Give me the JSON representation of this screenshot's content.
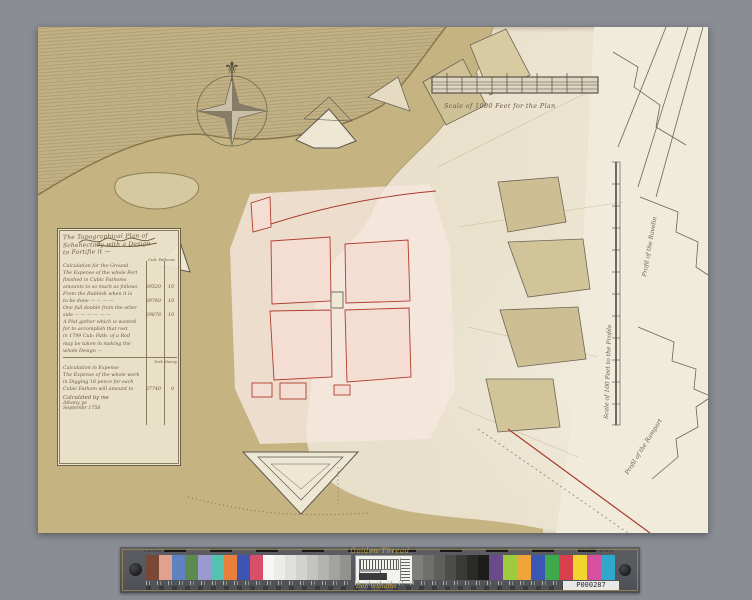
{
  "page": {
    "background": "#8a8e94"
  },
  "map": {
    "paper": "#e9e1cc",
    "ink": "#55504a",
    "river_tan": "#c5b482",
    "land_tan": "#c2b184",
    "town_pink": "#f4ded4",
    "accent_red": "#a93a2c",
    "cartouche": {
      "title_lines": [
        "The Topographical Plan of",
        "Schenectady with a Design",
        "to Fortifie it —"
      ],
      "col_header": "Cub: Fathoms",
      "rows": [
        {
          "t": "Calculation for the Ground",
          "v": "",
          "s": ""
        },
        {
          "t": "The Expense of the whole Fort",
          "v": "",
          "s": ""
        },
        {
          "t": "finished in Cubic Fathoms",
          "v": "",
          "s": ""
        },
        {
          "t": "amounts to so much as follows",
          "v": "69520",
          "s": "10"
        },
        {
          "t": "From the Rubbish when it is",
          "v": "",
          "s": ""
        },
        {
          "t": "to be done — — — —",
          "v": "39760",
          "s": "10"
        },
        {
          "t": "One full double from the other",
          "v": "",
          "s": ""
        },
        {
          "t": "side — — — — — —",
          "v": "29876",
          "s": "10"
        },
        {
          "t": "A Plat gather which is wanted",
          "v": "",
          "s": ""
        },
        {
          "t": "for to accomplish that rest",
          "v": "",
          "s": ""
        },
        {
          "t": "in 1799 Cub: Fath: of a Rod",
          "v": "",
          "s": ""
        },
        {
          "t": "may be taken in making the",
          "v": "",
          "s": ""
        },
        {
          "t": "whole Design —",
          "v": "",
          "s": ""
        }
      ],
      "col_header2": "York Money",
      "rows2": [
        {
          "t": "Calculation in Expense",
          "v": "",
          "s": ""
        },
        {
          "t": "The Expense of the whole work",
          "v": "",
          "s": ""
        },
        {
          "t": "in Digging 16 pence for each",
          "v": "",
          "s": ""
        },
        {
          "t": "Cubic Fathom will amount to",
          "v": "37740",
          "s": "0"
        }
      ],
      "closing": "Calculated by me",
      "place": "Albany ye",
      "date": "Septembr 1756"
    },
    "scale_bar_caption": "Scale of 1000 Feet for the Plan",
    "profile_scale_caption": "Scale of 100 Feet to the Profils",
    "label_profile_upper": "Profil of the Ravelin",
    "label_profile_lower": "Profil of the Rampart"
  },
  "calibration_bar": {
    "brand": "Golden Thread",
    "maker": "Don Williams",
    "unit_left": "inches",
    "unit_right": "centimeters",
    "plate_id": "P000287",
    "bar_bg": "#54575b",
    "gold": "#c9a53e",
    "left_color_patches": [
      "#7a4636",
      "#e0a28e",
      "#5f83c0",
      "#5d8a4e",
      "#9a9ad0",
      "#54c2b0",
      "#e8803b",
      "#3c55b2",
      "#d94f6a"
    ],
    "gray_ramp": [
      "#f7f7f5",
      "#ececea",
      "#e0e0de",
      "#d2d2d0",
      "#c3c3c1",
      "#b3b3b1",
      "#a2a2a0",
      "#929290"
    ],
    "dark_ramp": [
      "#7e7e7c",
      "#6e6e6c",
      "#5e5e5c",
      "#4c4c4a",
      "#3a3a38",
      "#2a2a28",
      "#1c1c1a"
    ],
    "right_color_patches": [
      "#6b4a8c",
      "#9ecb3d",
      "#f0a43a",
      "#3b56b5",
      "#3faa4c",
      "#d8404e",
      "#f2d431",
      "#d84fa0",
      "#2fa8cc"
    ]
  }
}
